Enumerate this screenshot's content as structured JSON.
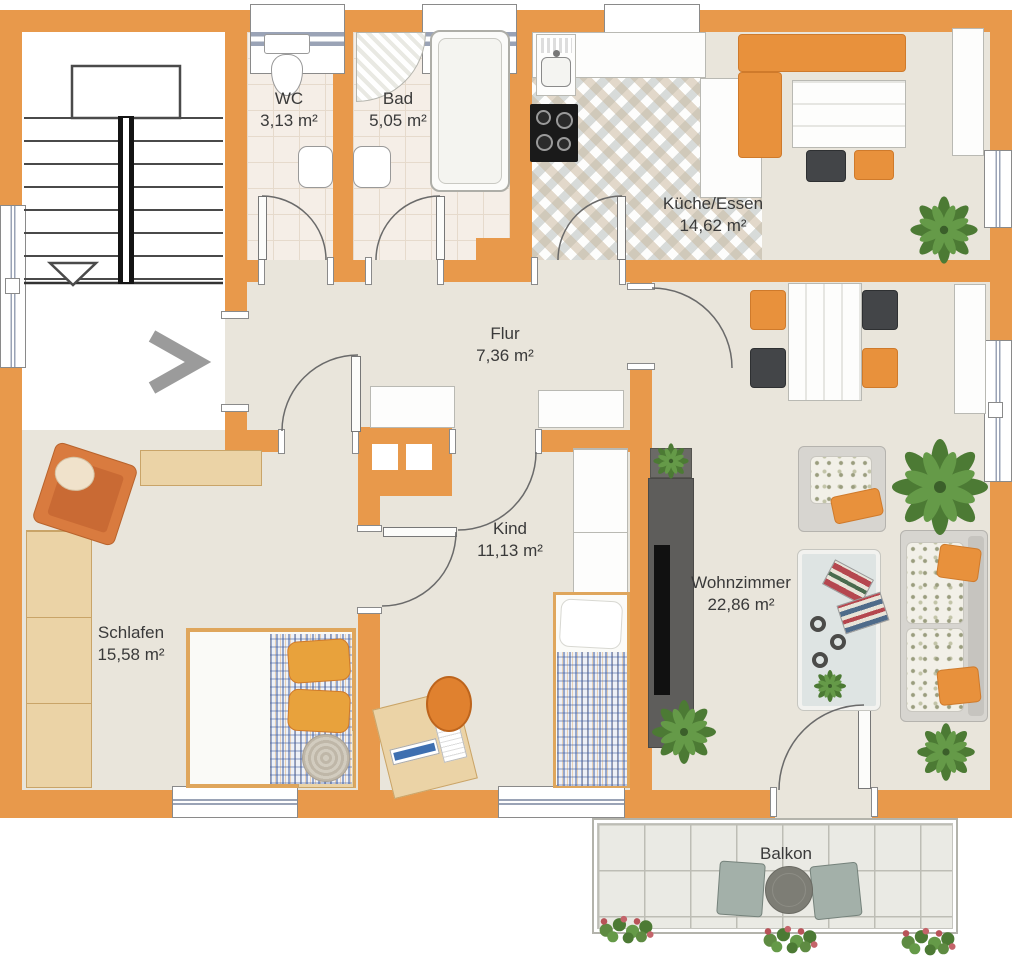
{
  "floorplan": {
    "rooms": [
      {
        "id": "wc",
        "name": "WC",
        "area": "3,13 m²"
      },
      {
        "id": "bad",
        "name": "Bad",
        "area": "5,05 m²"
      },
      {
        "id": "kueche_essen",
        "name": "Küche/Essen",
        "area": "14,62 m²"
      },
      {
        "id": "flur",
        "name": "Flur",
        "area": "7,36 m²"
      },
      {
        "id": "kind",
        "name": "Kind",
        "area": "11,13 m²"
      },
      {
        "id": "schlafen",
        "name": "Schlafen",
        "area": "15,58 m²"
      },
      {
        "id": "wohnzimmer",
        "name": "Wohnzimmer",
        "area": "22,86 m²"
      },
      {
        "id": "balkon",
        "name": "Balkon",
        "area": ""
      }
    ],
    "colors": {
      "wall": "#E8994B",
      "room_floor": "#E9E5DB",
      "bath_tile": "#F5EEE7",
      "balcony_tile": "#EAEAE4",
      "furniture_orange": "#E8913C",
      "wood": "#EBD3A6",
      "plant_green": "#4C7A34",
      "label_text": "#3A3A3A"
    }
  }
}
